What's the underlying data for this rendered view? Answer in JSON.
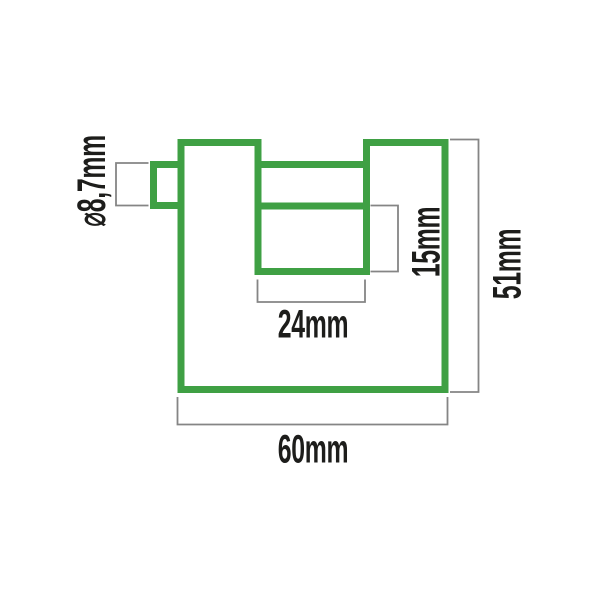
{
  "diagram": {
    "kind": "technical-dimension-drawing",
    "colors": {
      "outline_green": "#3fa044",
      "dimension_gray": "#858585",
      "label_text": "#1d1d1b",
      "background": "#ffffff"
    },
    "dimensions": {
      "shackle_diameter": {
        "label": "⌀8,7mm"
      },
      "shackle_opening_height": {
        "label": "15mm"
      },
      "shackle_opening_width": {
        "label": "24mm"
      },
      "body_height": {
        "label": "51mm"
      },
      "body_width": {
        "label": "60mm"
      }
    }
  }
}
